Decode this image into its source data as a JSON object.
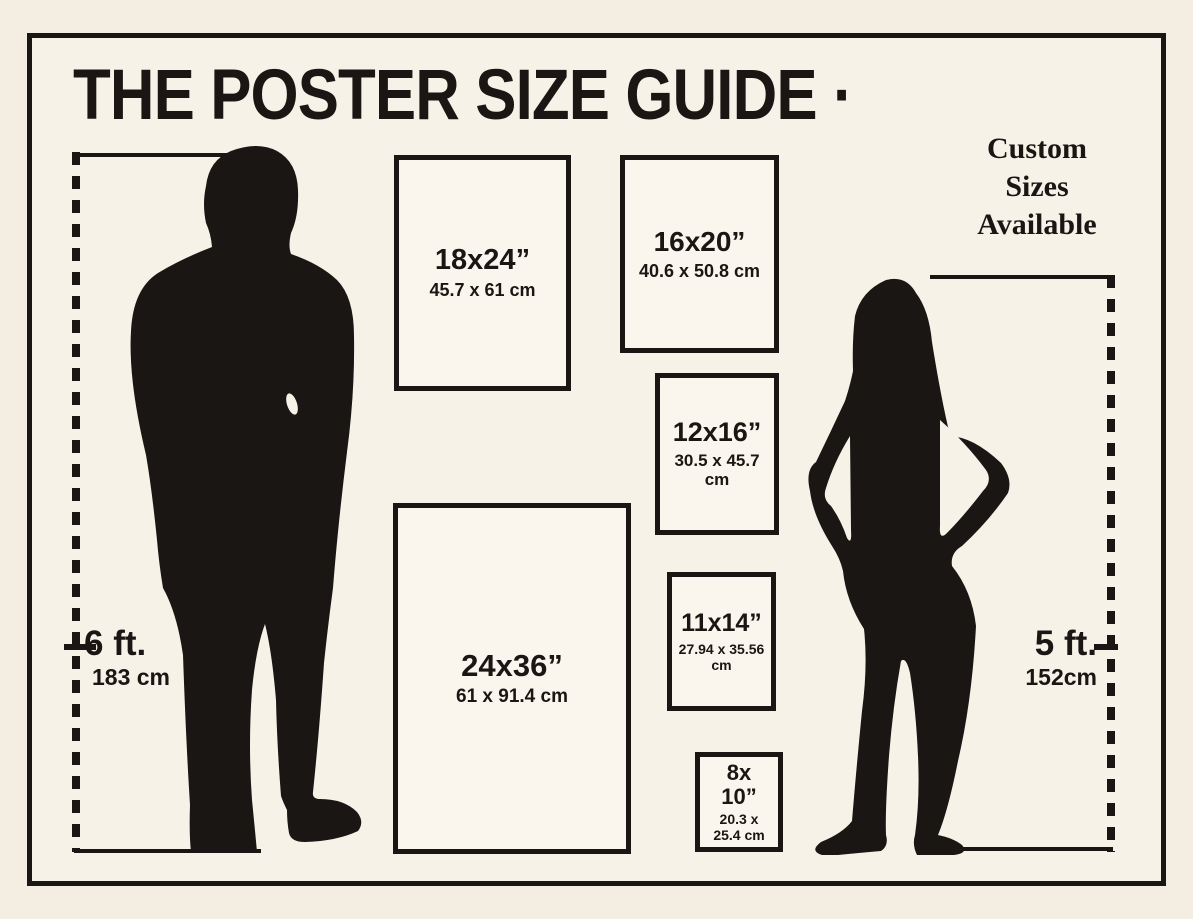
{
  "page": {
    "title": "THE POSTER SIZE GUIDE ·",
    "custom_note": "Custom Sizes Available"
  },
  "measurements": {
    "left": {
      "feet": "6 ft.",
      "cm": "183 cm"
    },
    "right": {
      "feet": "5 ft.",
      "cm": "152cm"
    }
  },
  "poster_sizes": [
    {
      "id": "18x24",
      "inches": "18x24”",
      "cm": "45.7 x 61 cm"
    },
    {
      "id": "16x20",
      "inches": "16x20”",
      "cm": "40.6 x 50.8 cm"
    },
    {
      "id": "12x16",
      "inches": "12x16”",
      "cm": "30.5 x 45.7 cm"
    },
    {
      "id": "24x36",
      "inches": "24x36”",
      "cm": "61 x 91.4 cm"
    },
    {
      "id": "11x14",
      "inches": "11x14”",
      "cm": "27.94 x 35.56 cm"
    },
    {
      "id": "8x10",
      "inches": "8x\n10”",
      "cm": "20.3 x\n25.4 cm"
    }
  ],
  "figures": {
    "man": "man-silhouette (6 ft reference)",
    "woman": "woman-silhouette (5 ft reference)"
  },
  "colors": {
    "ink": "#1a1613",
    "background": "#f3eee1",
    "panel": "#f7f2e8",
    "box_fill": "#faf6ed"
  }
}
